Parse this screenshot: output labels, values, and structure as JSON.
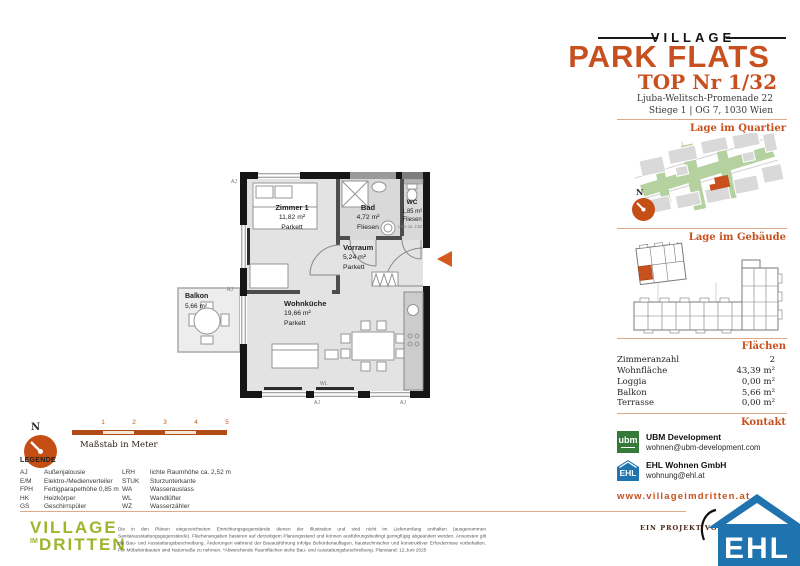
{
  "header": {
    "brand_top": "VILLAGE",
    "brand_main": "PARK FLATS",
    "unit_title": "TOP Nr 1/32",
    "address_line1": "Ljuba-Welitsch-Promenade 22",
    "address_line2": "Stiege 1 | OG 7, 1030 Wien"
  },
  "sections": {
    "quartier_label": "Lage im Quartier",
    "gebaeude_label": "Lage im Gebäude",
    "flaechen_label": "Flächen",
    "kontakt_label": "Kontakt"
  },
  "areas": {
    "rows": [
      {
        "label": "Zimmeranzahl",
        "value": "2"
      },
      {
        "label": "Wohnfläche",
        "value": "43,39 m²"
      },
      {
        "label": "Loggia",
        "value": "0,00 m²"
      },
      {
        "label": "Balkon",
        "value": "5,66 m²"
      },
      {
        "label": "Terrasse",
        "value": "0,00 m²"
      }
    ]
  },
  "contact": {
    "ubm_logo_text": "ubm",
    "ubm_name": "UBM Development",
    "ubm_email": "wohnen@ubm-development.com",
    "ehl_logo_text": "EHL",
    "ehl_name": "EHL Wohnen GmbH",
    "ehl_email": "wohnung@ehl.at",
    "website": "www.villageimdritten.at",
    "project_by": "EIN PROJEKT VON"
  },
  "compass": {
    "north_label": "N"
  },
  "floorplan": {
    "rooms": [
      {
        "name": "Zimmer 1",
        "area": "11,82 m²",
        "floor": "Parkett"
      },
      {
        "name": "Bad",
        "area": "4,72 m²",
        "floor": "Fliesen"
      },
      {
        "name": "WC",
        "area": "1,85 m²",
        "floor": "Fliesen"
      },
      {
        "name": "Vorraum",
        "area": "5,24 m²",
        "floor": "Parkett"
      },
      {
        "name": "Wohnküche",
        "area": "19,66 m²",
        "floor": "Parkett"
      },
      {
        "name": "Balkon",
        "area": "5,66 m²",
        "floor": ""
      }
    ],
    "codes": {
      "aj": "AJ",
      "wl": "WL",
      "lrh_note": "LRH ca. 2,52"
    }
  },
  "scale": {
    "ticks": [
      "1",
      "2",
      "3",
      "4",
      "5"
    ],
    "label": "Maßstab in Meter"
  },
  "legend": {
    "title": "LEGENDE",
    "left": [
      {
        "abbr": "AJ",
        "term": "Außenjalousie"
      },
      {
        "abbr": "E/M",
        "term": "Elektro-/Medienverteiler"
      },
      {
        "abbr": "FPH",
        "term": "Fertigparapethöhe 0,85 m"
      },
      {
        "abbr": "HK",
        "term": "Heizkörper"
      },
      {
        "abbr": "GS",
        "term": "Geschirrspüler"
      }
    ],
    "right": [
      {
        "abbr": "LRH",
        "term": "lichte Raumhöhe ca. 2,52 m"
      },
      {
        "abbr": "STUK",
        "term": "Sturzunterkante"
      },
      {
        "abbr": "WA",
        "term": "Wasserauslass"
      },
      {
        "abbr": "WL",
        "term": "Wandlüfter"
      },
      {
        "abbr": "WZ",
        "term": "Wasserzähler"
      }
    ]
  },
  "footer": {
    "logo_line1": "VILLAGE",
    "logo_im": "IM",
    "logo_line2": "DRITTEN",
    "disclaimer": "Die in den Plänen eingezeichneten Einrichtungsgegenstände dienen der Illustration und sind nicht im Lieferumfang enthalten (ausgenommen Sanitärausstattungsgegenstände). Flächenangaben basieren auf derzeitigem Planungsstand und können ausführungsbedingt geringfügig abgeändert werden. Ansonsten gilt die Bau- und Ausstattungsbeschreibung. Änderungen während der Bauausführung infolge Behördenauflagen, haustechnischer und konstruktiver Erfordernisse vorbehalten. Für Möbeleinbauten sind Naturmaße zu nehmen. *Abweichende Raumflächen siehe Bau- und Ausstattungsbeschreibung. Planstand: 12.Juni 2025"
  },
  "colors": {
    "accent_orange": "#c8501e",
    "ehl_blue": "#1f73ae",
    "ubm_green": "#35793b",
    "village_green": "#9fb42c"
  }
}
